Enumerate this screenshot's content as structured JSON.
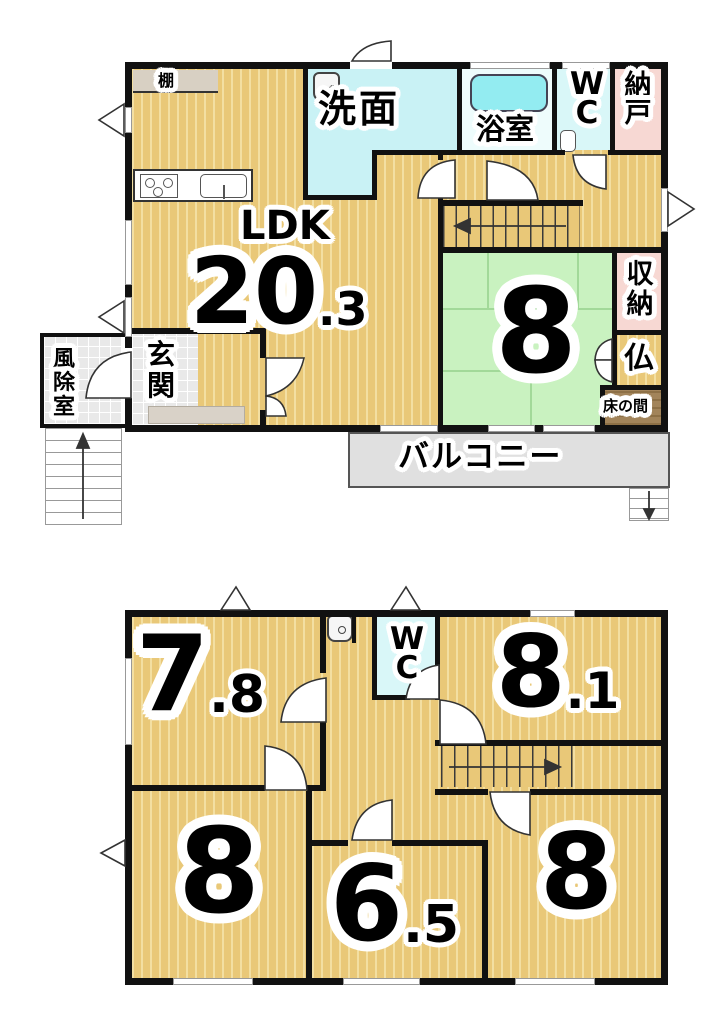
{
  "floor1": {
    "ldk": {
      "name": "LDK",
      "area_main": "20",
      "area_decimal": ".3"
    },
    "senmen": {
      "name": "洗面"
    },
    "bath": {
      "name": "浴室"
    },
    "wc": {
      "name": "WC"
    },
    "nando": {
      "name": "納戸"
    },
    "shelf": {
      "name": "棚"
    },
    "washitsu": {
      "area_main": "8"
    },
    "shuno": {
      "name": "収納"
    },
    "butsudan": {
      "name": "仏"
    },
    "tokonoma": {
      "name": "床の間"
    },
    "genkan": {
      "name": "玄関"
    },
    "fujoshitsu": {
      "name": "風除室"
    },
    "balcony": {
      "name": "バルコニー"
    }
  },
  "floor2": {
    "wc": {
      "name": "WC"
    },
    "room_nw": {
      "area_main": "7",
      "area_decimal": ".8"
    },
    "room_ne": {
      "area_main": "8",
      "area_decimal": ".1"
    },
    "room_sw": {
      "area_main": "8"
    },
    "room_s": {
      "area_main": "6",
      "area_decimal": ".5"
    },
    "room_se": {
      "area_main": "8"
    }
  },
  "colors": {
    "wood_floor": "#e9c878",
    "tatami_green": "#c9f2c0",
    "wet_area_cyan": "#c9f2f5",
    "closet_pink": "#f7d8d3",
    "balcony_gray": "#e0e0e0",
    "tokonoma_brown": "#a2845a",
    "wall_black": "#111111"
  }
}
